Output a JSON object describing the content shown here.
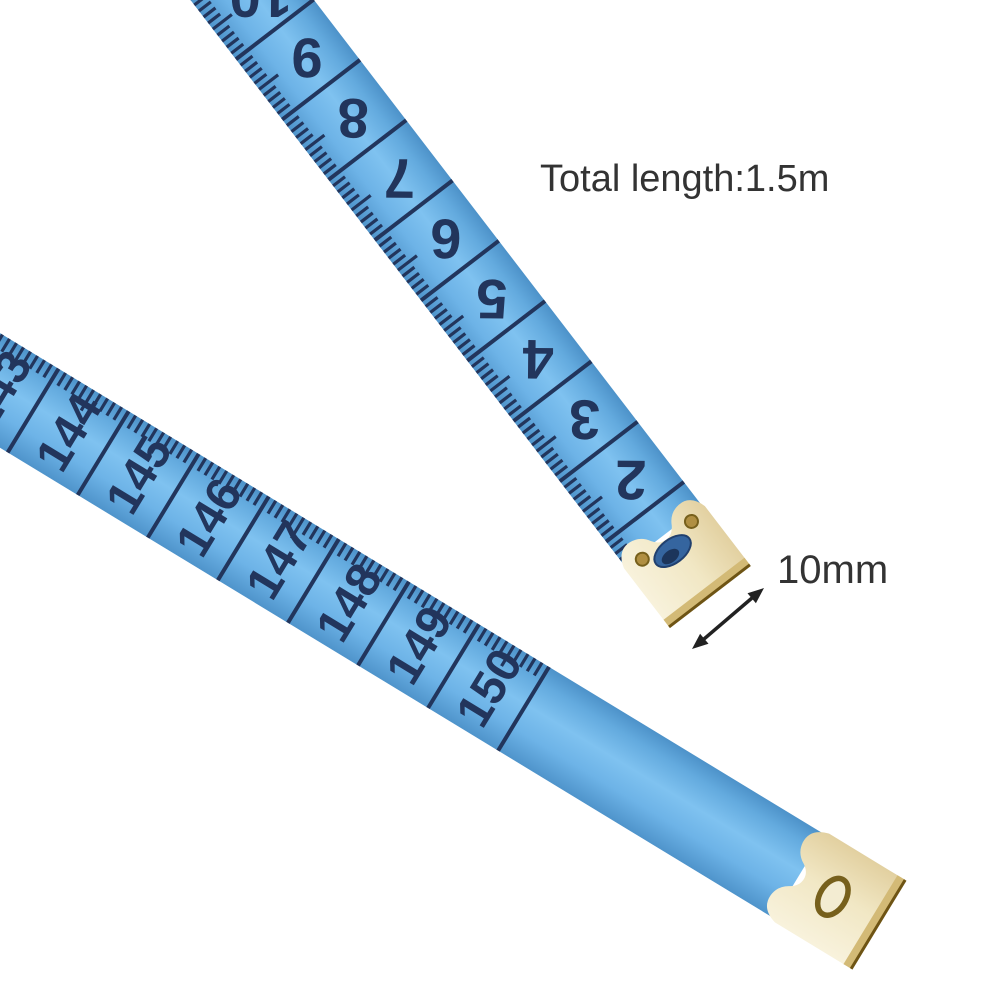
{
  "page": {
    "background": "#ffffff"
  },
  "labels": {
    "total_length": "Total length:1.5m",
    "tip_width": "10mm"
  },
  "tape_upper": {
    "visible_numbers": [
      "2",
      "3",
      "4",
      "5",
      "6",
      "7",
      "8",
      "9",
      "10"
    ]
  },
  "tape_lower": {
    "visible_numbers": [
      "143",
      "144",
      "145",
      "146",
      "147",
      "148",
      "149",
      "150"
    ]
  },
  "colors": {
    "tape_blue": "#5aa4dc",
    "tape_blue_light": "#82c3f0",
    "tape_blue_dark": "#4f94cb",
    "markings_navy": "#22355c",
    "metal_gold": "#f2e9cb",
    "metal_gold_dark": "#d3ba76",
    "metal_edge": "#6e5414",
    "rivet_brass": "#b08f42",
    "slot_blue": "#35659f",
    "label_text": "#333333",
    "arrow": "#222222"
  }
}
